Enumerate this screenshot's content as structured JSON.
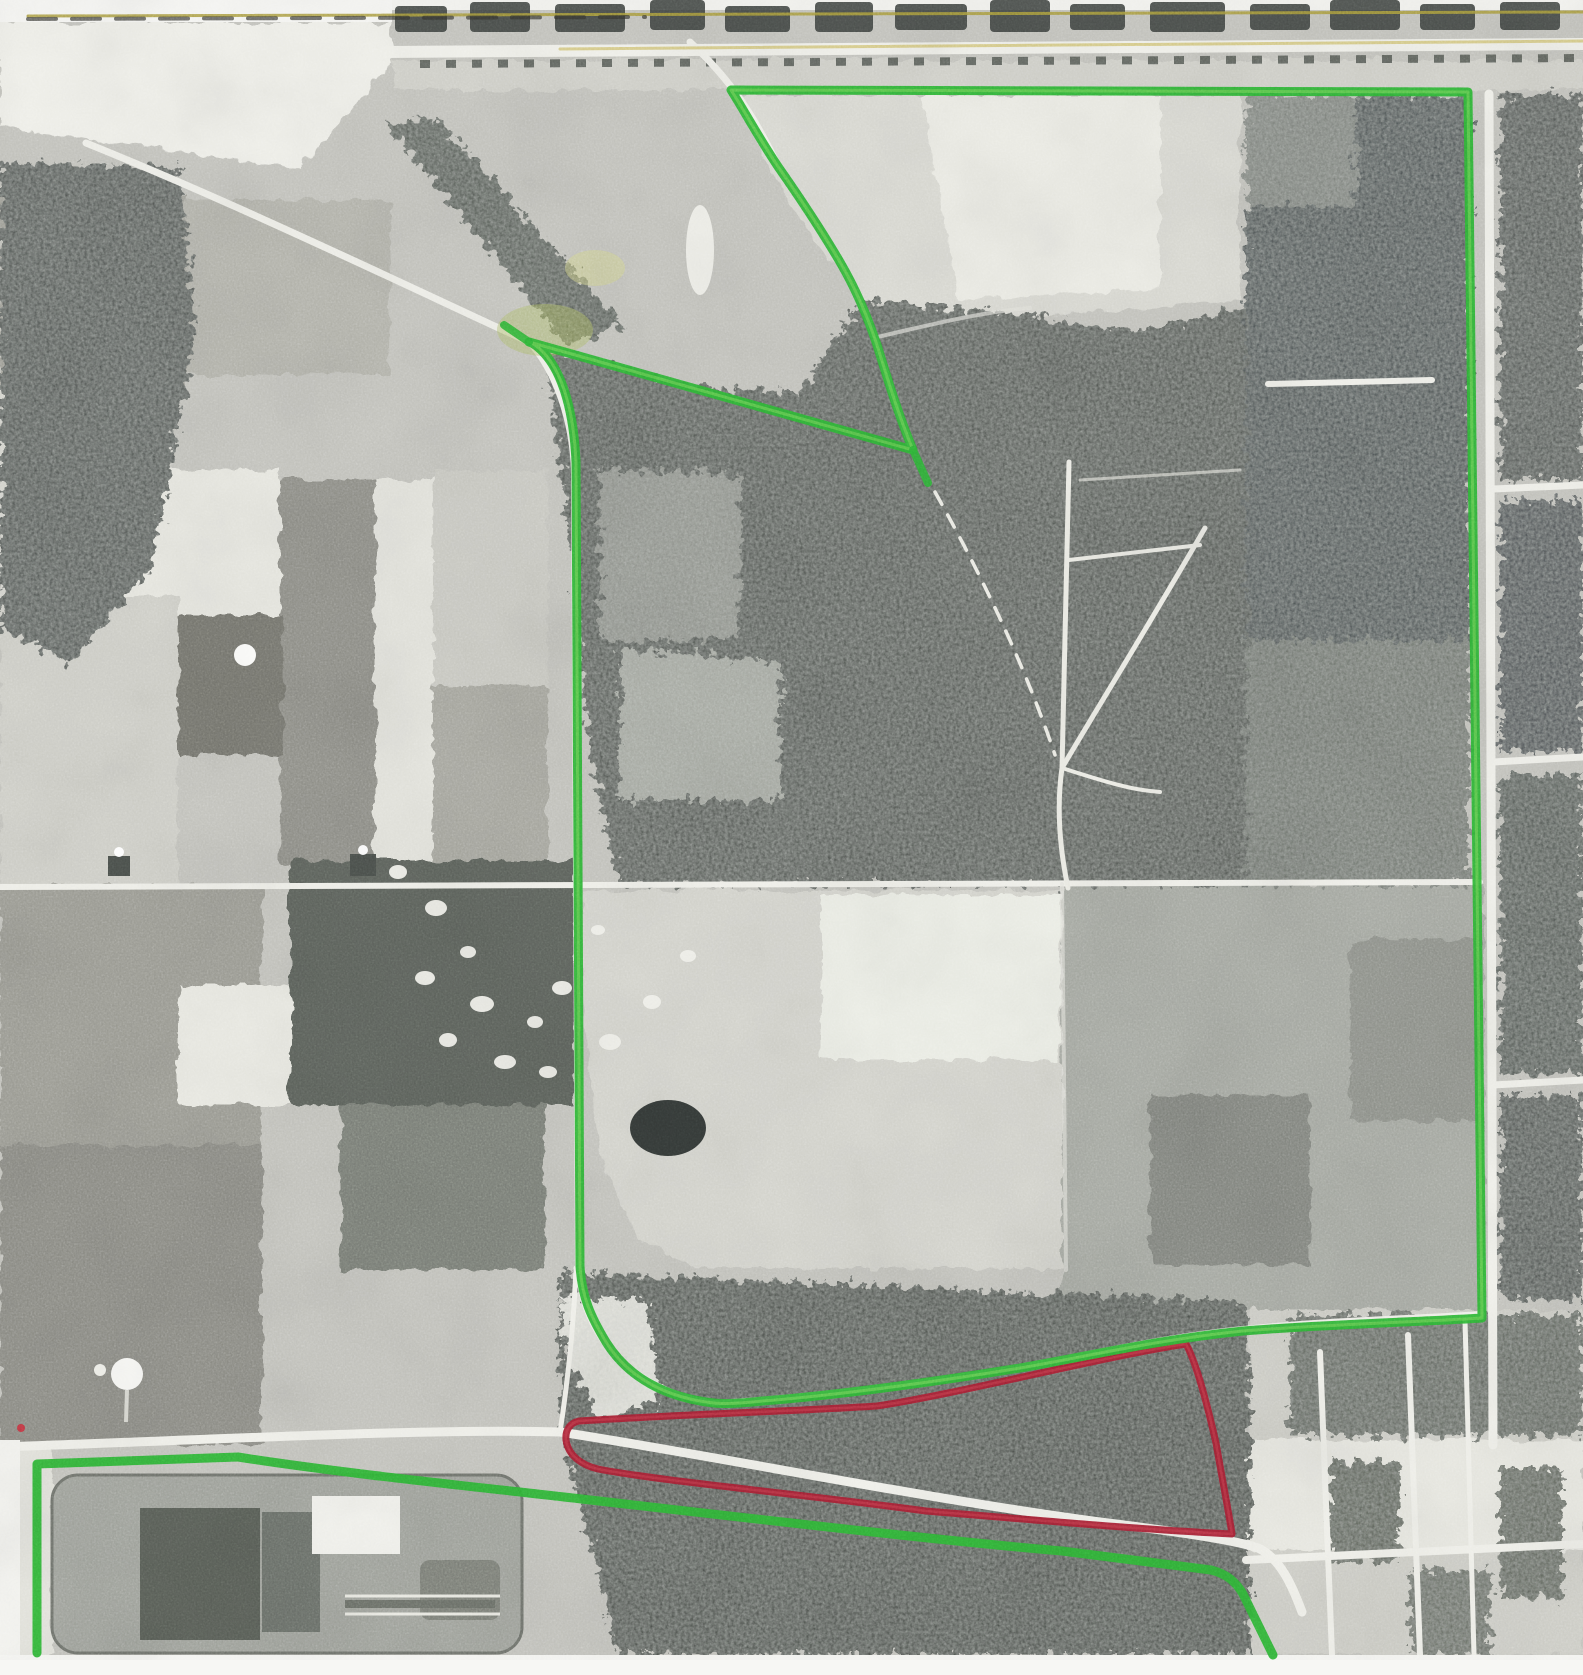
{
  "page": {
    "title": "Scanned black-and-white aerial photograph with hand-drawn parcel boundaries",
    "media": "photocopy-scan",
    "width_px": 1583,
    "height_px": 1675
  },
  "photo": {
    "description": "Monochrome aerial view: patchwork farm fields upper-left, large dark wooded tracts center and right, east-west road across middle, highway strip along top, treatment-plant complex lower-left, street grid along right edge",
    "paper_color": "#f6f6f3",
    "base_gray": "#c3c3bd"
  },
  "annotations": {
    "main_parcel": {
      "label": "large-green-parcel-outline",
      "color": "#2eb336",
      "highlight_color": "#7fd95d",
      "stroke_width": 9,
      "path": "M 731 90 L 1468 92 L 1482 1318 C 1420 1322 1330 1324 1243 1331 C 1155 1340 1090 1356 1020 1368 C 935 1382 830 1396 762 1401 C 735 1404 723 1404 714 1403 C 668 1398 629 1379 606 1342 C 591 1317 582 1298 580 1266 L 576 462 C 574 416 564 373 542 351 C 537 346 533 343 529 342 L 913 450 C 898 414 888 380 877 345 C 868 318 857 291 840 262 C 820 228 800 198 779 168 C 760 140 745 112 731 90 Z"
    },
    "main_parcel_junction_overshoot": {
      "path": "M 529 342 L 504 325"
    },
    "main_parcel_vertex_overshoot": {
      "path": "M 913 450 L 928 483"
    },
    "south_parcel": {
      "label": "bottom-green-parcel-outline",
      "color": "#2eb336",
      "stroke_width": 9,
      "path": "M 37 1653 L 37 1464 L 238 1457 C 320 1470 430 1482 520 1492 C 680 1510 930 1540 1062 1551 L 1211 1570 C 1227 1574 1236 1582 1243 1594 L 1273 1655"
    },
    "red_wedge": {
      "label": "red-wedge-parcel-outline",
      "color": "#a52134",
      "highlight_color": "#c4404e",
      "stroke_width": 7,
      "path": "M 579 1421 C 690 1414 800 1411 877 1406 C 958 1394 1105 1356 1186 1344 C 1196 1362 1206 1399 1216 1443 C 1223 1483 1229 1514 1232 1534 C 1150 1530 1058 1522 926 1511 C 792 1493 660 1481 598 1469 C 581 1465 568 1455 566 1440 C 565 1430 570 1423 579 1421 Z"
    },
    "scan_line_top_yellow": {
      "color": "#a89a3c",
      "stroke_width": 3,
      "path": "M 28 16 L 1583 12"
    },
    "scan_line_top_dashes": {
      "color": "#35352f",
      "stroke_width": 4,
      "path": "M 28 19 L 645 17"
    },
    "scan_line_highway_yellow": {
      "color": "#cfc06a",
      "stroke_width": 3,
      "path": "M 560 49 L 1583 41"
    },
    "scan_speck_red": {
      "color": "#c03a45",
      "cx": 21,
      "cy": 1428,
      "r": 4
    }
  }
}
